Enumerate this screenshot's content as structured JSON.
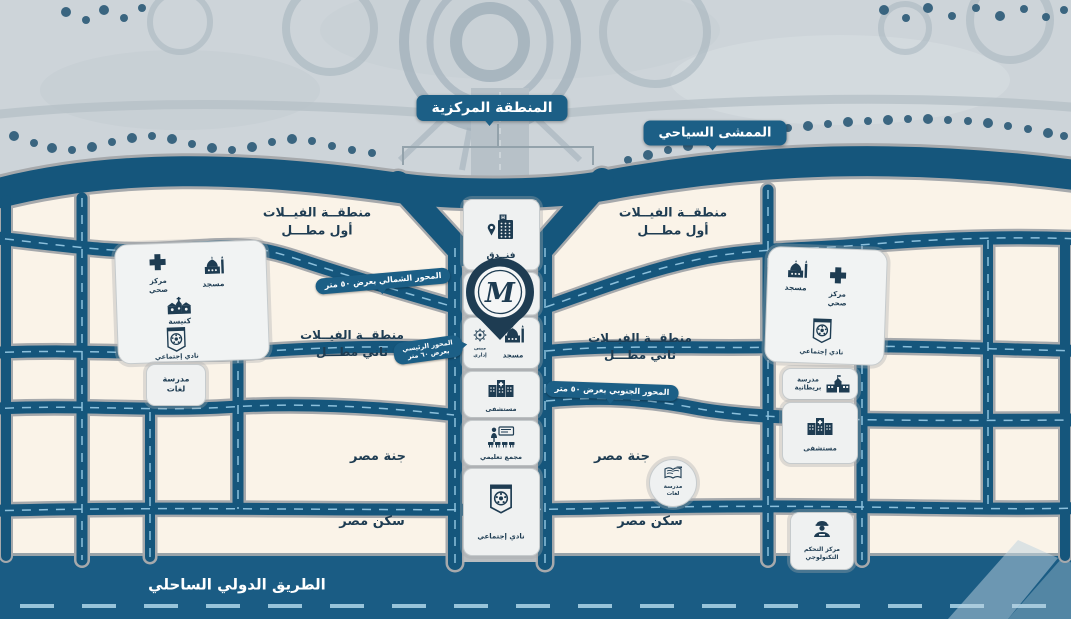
{
  "logo": {
    "monogram": "M"
  },
  "badges": {
    "central_zone": "المنطقة المركزية",
    "tourist_walkway": "الممشى السياحي"
  },
  "roads": {
    "north_axis": "المحور الشمالي بعرض ٥٠ متر",
    "south_axis": "المحور الجنوبي بعرض ٥٠ متر",
    "main_axis_l1": "المحور الرئيسي",
    "main_axis_l2": "بعرض ٦٠ متر",
    "coastal": "الطريق الدولي الساحلي"
  },
  "districts": {
    "villas_line1": "منطقــة الفيــلات",
    "first_view": "أول مطـــل",
    "second_view": "ثاني مطـــل",
    "janna": "جنة مصر",
    "sakan": "سكن مصر"
  },
  "amenities": {
    "hotel": "فنــدق",
    "mosque": "مسجد",
    "health_l1": "مركز",
    "health_l2": "صحي",
    "church": "كنيسة",
    "club": "نادي إجتماعي",
    "hospital": "مستشفى",
    "edu": "مجمع تعليمي",
    "school": "مدرسة",
    "lang": "لغات",
    "british": "بريطانية",
    "admin_l1": "مبنى",
    "admin_l2": "إداري",
    "control_l1": "مركز التحكم",
    "control_l2": "التكنولوجي"
  },
  "colors": {
    "road": "#15567c",
    "coastal_band": "#1a5c84",
    "badge": "#1c5f86",
    "background": "#faf3e8",
    "navy_icon": "#1e3c52",
    "dash": "#8cc0dc"
  }
}
